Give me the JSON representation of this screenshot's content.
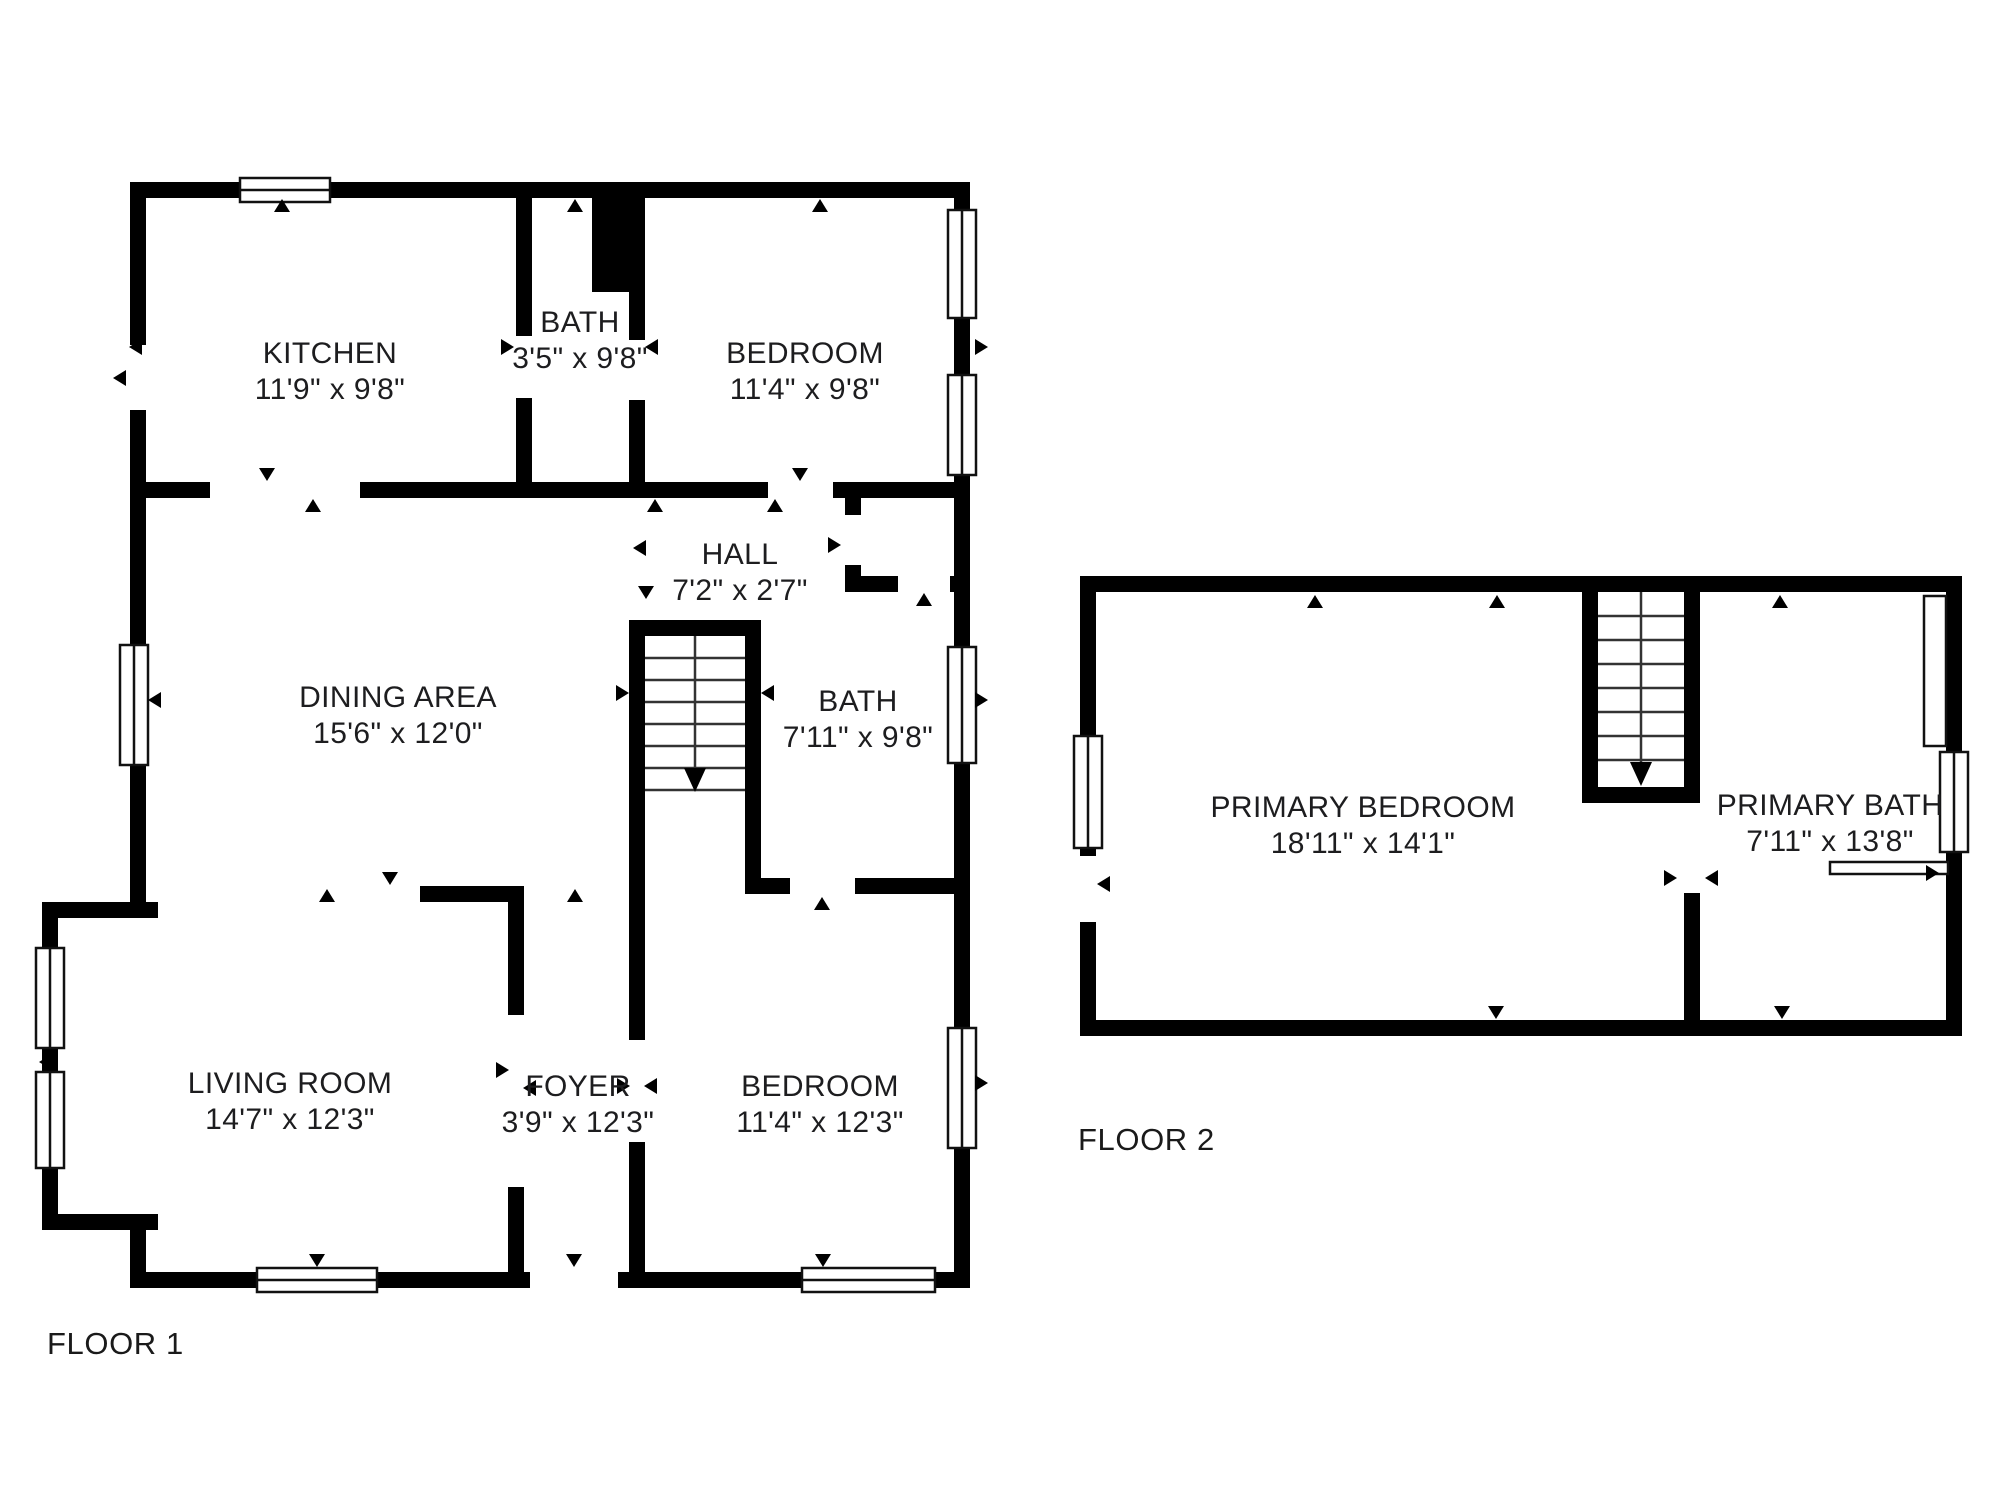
{
  "colors": {
    "wall": "#000000",
    "background": "#ffffff",
    "text": "#1d1d1f"
  },
  "icons": {
    "opening_marker_icon": "▲",
    "stair_down_icon": "↓",
    "window_icon": "double-line-rect"
  },
  "floor1": {
    "label": "FLOOR 1",
    "rooms": {
      "kitchen": {
        "name": "KITCHEN",
        "dims": "11'9\" x 9'8\""
      },
      "bath_top": {
        "name": "BATH",
        "dims": "3'5\" x 9'8\""
      },
      "bedroom_top": {
        "name": "BEDROOM",
        "dims": "11'4\" x 9'8\""
      },
      "hall": {
        "name": "HALL",
        "dims": "7'2\" x 2'7\""
      },
      "dining_area": {
        "name": "DINING AREA",
        "dims": "15'6\" x 12'0\""
      },
      "bath_mid": {
        "name": "BATH",
        "dims": "7'11\" x 9'8\""
      },
      "living_room": {
        "name": "LIVING ROOM",
        "dims": "14'7\" x 12'3\""
      },
      "foyer": {
        "name": "FOYER",
        "dims": "3'9\" x 12'3\""
      },
      "bedroom_bottom": {
        "name": "BEDROOM",
        "dims": "11'4\" x 12'3\""
      }
    }
  },
  "floor2": {
    "label": "FLOOR 2",
    "rooms": {
      "primary_bedroom": {
        "name": "PRIMARY BEDROOM",
        "dims": "18'11\" x 14'1\""
      },
      "primary_bath": {
        "name": "PRIMARY BATH",
        "dims": "7'11\" x 13'8\""
      }
    }
  }
}
